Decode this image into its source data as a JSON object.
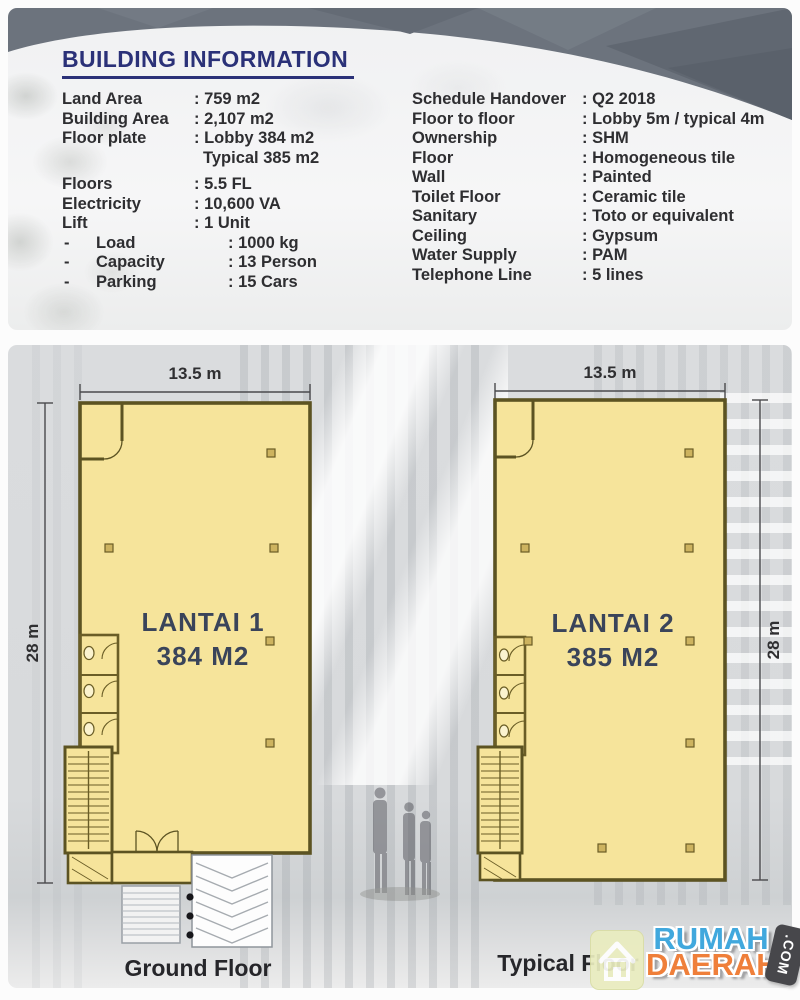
{
  "building_info": {
    "title": "BUILDING INFORMATION",
    "left": [
      {
        "bullet": "",
        "label": "Land Area",
        "value": ": 759 m2"
      },
      {
        "bullet": "",
        "label": "Building Area",
        "value": ": 2,107 m2"
      },
      {
        "bullet": "",
        "label": "Floor plate",
        "value": ": Lobby 384 m2",
        "value2": "Typical 385 m2"
      },
      {
        "bullet": "",
        "label": "Floors",
        "value": ": 5.5 FL"
      },
      {
        "bullet": "",
        "label": "Electricity",
        "value": ": 10,600 VA"
      },
      {
        "bullet": "",
        "label": "Lift",
        "value": ": 1 Unit"
      },
      {
        "bullet": "-",
        "label": "Load",
        "value": ": 1000 kg"
      },
      {
        "bullet": "-",
        "label": "Capacity",
        "value": ": 13 Person"
      },
      {
        "bullet": "-",
        "label": "Parking",
        "value": ": 15 Cars"
      }
    ],
    "right": [
      {
        "label": "Schedule Handover",
        "value": ": Q2 2018"
      },
      {
        "label": "Floor to floor",
        "value": ": Lobby 5m / typical 4m"
      },
      {
        "label": "Ownership",
        "value": ": SHM"
      },
      {
        "label": "Floor",
        "value": ": Homogeneous tile"
      },
      {
        "label": "Wall",
        "value": ": Painted"
      },
      {
        "label": "Toilet Floor",
        "value": ": Ceramic tile"
      },
      {
        "label": "Sanitary",
        "value": ": Toto or equivalent"
      },
      {
        "label": "Ceiling",
        "value": ": Gypsum"
      },
      {
        "label": "Water Supply",
        "value": ": PAM"
      },
      {
        "label": "Telephone Line",
        "value": ": 5 lines"
      }
    ]
  },
  "plans": {
    "ground": {
      "title": "LANTAI 1",
      "area": "384 M2",
      "width": "13.5 m",
      "height": "28 m",
      "caption": "Ground Floor"
    },
    "typical": {
      "title": "LANTAI 2",
      "area": "385 M2",
      "width": "13.5 m",
      "height": "28 m",
      "caption": "Typical Floor"
    }
  },
  "watermark": {
    "word1": "RUMAH",
    "word2": "DAERAH",
    "suffix": ".COM",
    "icon": "house-icon"
  },
  "colors": {
    "accent_navy": "#2b3178",
    "plan_fill": "#f6e49b",
    "plan_wall": "#5c5322",
    "panel_gray": "#d9dbdd",
    "band_gray": "#6c737d",
    "brand_blue": "#41a8dd",
    "brand_orange": "#ef7f3a"
  }
}
